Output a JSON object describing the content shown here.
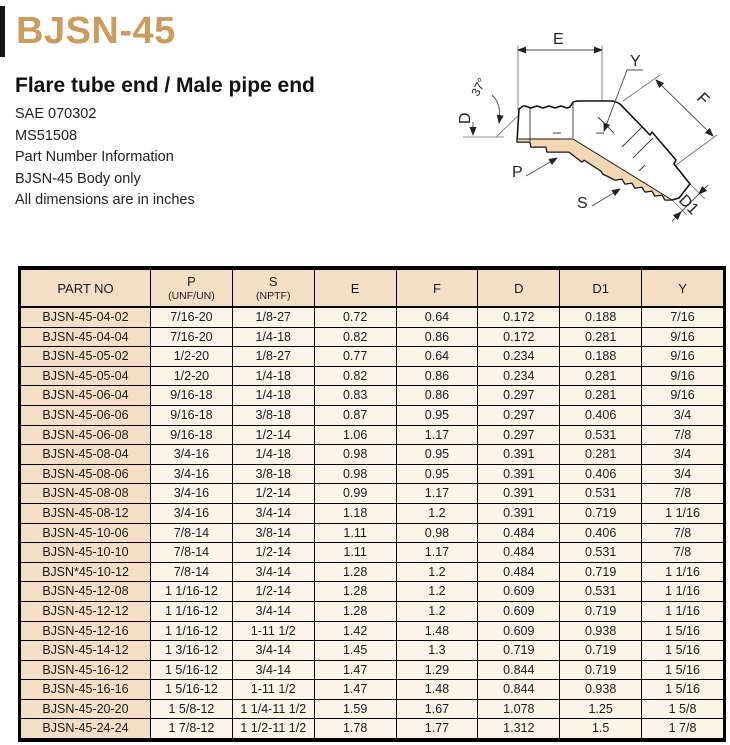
{
  "page": {
    "title": "BJSN-45",
    "subtitle": "Flare tube end / Male pipe end",
    "info_lines": [
      "SAE 070302",
      "MS51508",
      "Part Number Information",
      "BJSN-45 Body only",
      "All dimensions are in inches"
    ],
    "accent_color": "#cc9b5e"
  },
  "diagram": {
    "description": "45-degree elbow fitting, flare tube end left, male pipe end lower right",
    "fill_color": "#f1d7b2",
    "labels": {
      "e": "E",
      "y": "Y",
      "f": "F",
      "d": "D",
      "angle": "37°",
      "p": "P",
      "s": "S",
      "d1": "D1"
    }
  },
  "table": {
    "columns": [
      {
        "label": "PART NO",
        "sub": ""
      },
      {
        "label": "P",
        "sub": "(UNF/UN)"
      },
      {
        "label": "S",
        "sub": "(NPTF)"
      },
      {
        "label": "E",
        "sub": ""
      },
      {
        "label": "F",
        "sub": ""
      },
      {
        "label": "D",
        "sub": ""
      },
      {
        "label": "D1",
        "sub": ""
      },
      {
        "label": "Y",
        "sub": ""
      }
    ],
    "rows": [
      [
        "BJSN-45-04-02",
        "7/16-20",
        "1/8-27",
        "0.72",
        "0.64",
        "0.172",
        "0.188",
        "7/16"
      ],
      [
        "BJSN-45-04-04",
        "7/16-20",
        "1/4-18",
        "0.82",
        "0.86",
        "0.172",
        "0.281",
        "9/16"
      ],
      [
        "BJSN-45-05-02",
        "1/2-20",
        "1/8-27",
        "0.77",
        "0.64",
        "0.234",
        "0.188",
        "9/16"
      ],
      [
        "BJSN-45-05-04",
        "1/2-20",
        "1/4-18",
        "0.82",
        "0.86",
        "0.234",
        "0.281",
        "9/16"
      ],
      [
        "BJSN-45-06-04",
        "9/16-18",
        "1/4-18",
        "0.83",
        "0.86",
        "0.297",
        "0.281",
        "9/16"
      ],
      [
        "BJSN-45-06-06",
        "9/16-18",
        "3/8-18",
        "0.87",
        "0.95",
        "0.297",
        "0.406",
        "3/4"
      ],
      [
        "BJSN-45-06-08",
        "9/16-18",
        "1/2-14",
        "1.06",
        "1.17",
        "0.297",
        "0.531",
        "7/8"
      ],
      [
        "BJSN-45-08-04",
        "3/4-16",
        "1/4-18",
        "0.98",
        "0.95",
        "0.391",
        "0.281",
        "3/4"
      ],
      [
        "BJSN-45-08-06",
        "3/4-16",
        "3/8-18",
        "0.98",
        "0.95",
        "0.391",
        "0.406",
        "3/4"
      ],
      [
        "BJSN-45-08-08",
        "3/4-16",
        "1/2-14",
        "0.99",
        "1.17",
        "0.391",
        "0.531",
        "7/8"
      ],
      [
        "BJSN-45-08-12",
        "3/4-16",
        "3/4-14",
        "1.18",
        "1.2",
        "0.391",
        "0.719",
        "1 1/16"
      ],
      [
        "BJSN-45-10-06",
        "7/8-14",
        "3/8-14",
        "1.11",
        "0.98",
        "0.484",
        "0.406",
        "7/8"
      ],
      [
        "BJSN-45-10-10",
        "7/8-14",
        "1/2-14",
        "1.11",
        "1.17",
        "0.484",
        "0.531",
        "7/8"
      ],
      [
        "BJSN*45-10-12",
        "7/8-14",
        "3/4-14",
        "1.28",
        "1.2",
        "0.484",
        "0.719",
        "1 1/16"
      ],
      [
        "BJSN-45-12-08",
        "1 1/16-12",
        "1/2-14",
        "1.28",
        "1.2",
        "0.609",
        "0.531",
        "1 1/16"
      ],
      [
        "BJSN-45-12-12",
        "1 1/16-12",
        "3/4-14",
        "1.28",
        "1.2",
        "0.609",
        "0.719",
        "1 1/16"
      ],
      [
        "BJSN-45-12-16",
        "1 1/16-12",
        "1-11 1/2",
        "1.42",
        "1.48",
        "0.609",
        "0.938",
        "1 5/16"
      ],
      [
        "BJSN-45-14-12",
        "1 3/16-12",
        "3/4-14",
        "1.45",
        "1.3",
        "0.719",
        "0.719",
        "1 5/16"
      ],
      [
        "BJSN-45-16-12",
        "1 5/16-12",
        "3/4-14",
        "1.47",
        "1.29",
        "0.844",
        "0.719",
        "1 5/16"
      ],
      [
        "BJSN-45-16-16",
        "1 5/16-12",
        "1-11 1/2",
        "1.47",
        "1.48",
        "0.844",
        "0.938",
        "1 5/16"
      ],
      [
        "BJSN-45-20-20",
        "1 5/8-12",
        "1 1/4-11 1/2",
        "1.59",
        "1.67",
        "1.078",
        "1.25",
        "1 5/8"
      ],
      [
        "BJSN-45-24-24",
        "1 7/8-12",
        "1 1/2-11 1/2",
        "1.78",
        "1.77",
        "1.312",
        "1.5",
        "1 7/8"
      ]
    ]
  }
}
